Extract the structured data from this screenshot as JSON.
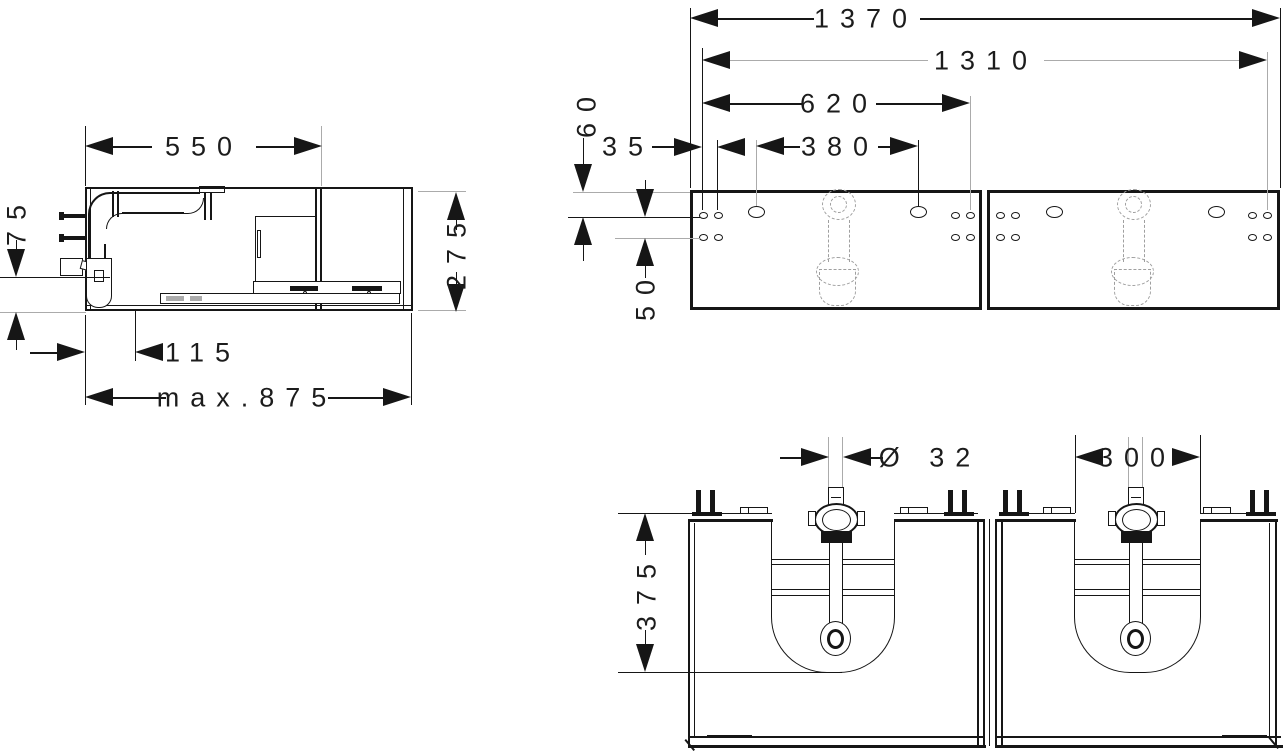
{
  "colors": {
    "line": "#161616",
    "reference": "#ababab",
    "hidden": "#9f9f9f"
  },
  "side_view": {
    "top_depth": "550",
    "outlet_height": "75",
    "height": "275",
    "trap_offset": "115",
    "max_depth": "max.875"
  },
  "top_view": {
    "overall_width": "1370",
    "mounting_span": "1310",
    "left_section_span": "620",
    "oval_hole_spacing": "380",
    "edge_hole_offset": "35",
    "front_hole_offset": "60",
    "hole_row_spacing": "50"
  },
  "front_view": {
    "drain_diameter": "Ø 32",
    "cutout_width": "300",
    "cutout_height": "375"
  }
}
